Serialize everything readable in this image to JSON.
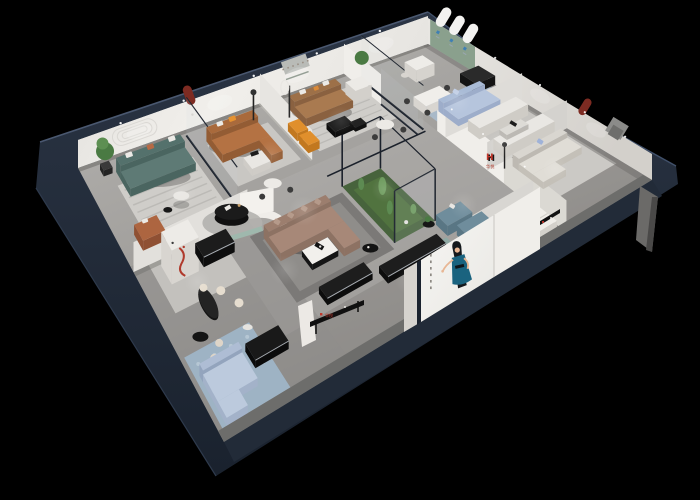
{
  "scene": {
    "type": "3d-dollhouse-showroom-render",
    "background_color": "#000000"
  },
  "brand": {
    "monogram": "H",
    "name": "华悦",
    "logo_red": "#c2372b",
    "logo_black": "#17181a"
  },
  "poster": {
    "background": "#f2f1ee",
    "figure": "woman-in-teal-dress-illustration",
    "dress_color": "#1a637f",
    "hair_color": "#14181c",
    "skin_color": "#e8b795"
  },
  "palette": {
    "bg": "#000000",
    "shell_navy": "#232c3a",
    "shell_navy_dark": "#161d28",
    "shell_edge": "#46546c",
    "shell_lip": "#6d6d6b",
    "floor_a": "#b2b0ad",
    "floor_b": "#8e8c89",
    "floor_dark": "#7b7977",
    "wall_bright": "#f0eeea",
    "wall_white": "#e7e5e1",
    "wall_mid": "#d6d3ce",
    "wall_shade": "#c2bfb9",
    "wall_grey": "#9b9894",
    "rug_light": "#cfcdc9",
    "rug_stripe": "#b7b5b1",
    "rug_blue": "#a9b9c8",
    "rug_blue2": "#9eb3c4",
    "rug_dark": "#7b7977",
    "teal_sofa": "#5e7a75",
    "teal_dark": "#4a6560",
    "caramel": "#b47243",
    "caramel_dark": "#935c34",
    "tan_sofa": "#a97a50",
    "tan_dark": "#8a6140",
    "mauve": "#a78878",
    "mauve_dark": "#8d7263",
    "powder": "#b6c5dd",
    "powder_dark": "#9dadca",
    "steel": "#6f8d9c",
    "steel_dark": "#597684",
    "cream": "#e9e7e3",
    "cream_dark": "#cfccc6",
    "beige": "#e0ddd6",
    "beige_dark": "#c4c0b8",
    "terracotta": "#ad6540",
    "terracotta_dark": "#8f5033",
    "orange": "#e59231",
    "orange_dark": "#c2781f",
    "niche_red": "#7d2b22",
    "arch_red": "#8c3a2e",
    "red_accent": "#b03a2c",
    "green_wall": "#8aa08d",
    "arch_white": "#f3f2f0",
    "arch_blue": "#3f7fb4",
    "plant": "#4a7a43",
    "plant_light": "#5d8f52",
    "grass": "#47633c",
    "cactus": "#5d8b52",
    "black_f": "#181818",
    "black_deep": "#0c0c0c",
    "grey_f": "#3c3c3c",
    "chrome": "#a8adb3",
    "glass_frame": "#1b212b",
    "glass_sheen": "#cdd6dc",
    "bed_white": "#f0eee9",
    "bed_shadow": "#d4d1cb",
    "light": "#ffffff"
  },
  "lighting": {
    "style": "recessed ceiling spotlights",
    "dot_color": "#ffffff"
  },
  "rooms": [
    {
      "name": "west-lounge",
      "sofa_color": "#5e7a75",
      "features": [
        "stadium-line wall relief",
        "green plant",
        "white round coffee table",
        "terracotta armchair",
        "striped rug"
      ]
    },
    {
      "name": "caramel-lounge",
      "sofa_color": "#b47243",
      "features": [
        "red arched wall niche",
        "caramel leather sofa",
        "orange pillow",
        "white coffee table",
        "black floor lamp"
      ]
    },
    {
      "name": "north-lounge",
      "sofa_color": "#a97a50",
      "features": [
        "tan leather sofa",
        "white armchair",
        "black nesting tables",
        "recessed wall niche",
        "orange benches"
      ]
    },
    {
      "name": "arch-gallery",
      "wall_color": "#8aa08d",
      "features": [
        "three white arched panels with blue brand marks",
        "white armchair"
      ]
    },
    {
      "name": "dining-corner",
      "sofa_color": "#b6c5dd",
      "features": [
        "powder blue sofa",
        "dining table with chairs",
        "glass partition",
        "dark sideboard"
      ]
    },
    {
      "name": "east-suite",
      "sofa_color": "#e9e7e3",
      "features": [
        "facing cream sofas",
        "red arched niche",
        "black display shelf with red pieces"
      ]
    },
    {
      "name": "east-living",
      "sofa_color": "#e0ddd6",
      "features": [
        "beige sectional",
        "grey wall TV panel",
        "floor lamp"
      ]
    },
    {
      "name": "front-bedroom",
      "features": [
        "white bed",
        "round black rug",
        "billboard poster on cut wall"
      ]
    },
    {
      "name": "central-showroom",
      "sofa_color": "#a78878",
      "features": [
        "curved white partition",
        "mauve L-sectional",
        "black oval display table",
        "glass atrium with cacti",
        "steel-blue armchairs",
        "black media benches",
        "logo shelf"
      ]
    },
    {
      "name": "south-cafe",
      "features": [
        "black oval bar table",
        "cream bar stools",
        "white display cabinet with red curve",
        "pale blue sectional",
        "blue patterned rug"
      ]
    }
  ]
}
